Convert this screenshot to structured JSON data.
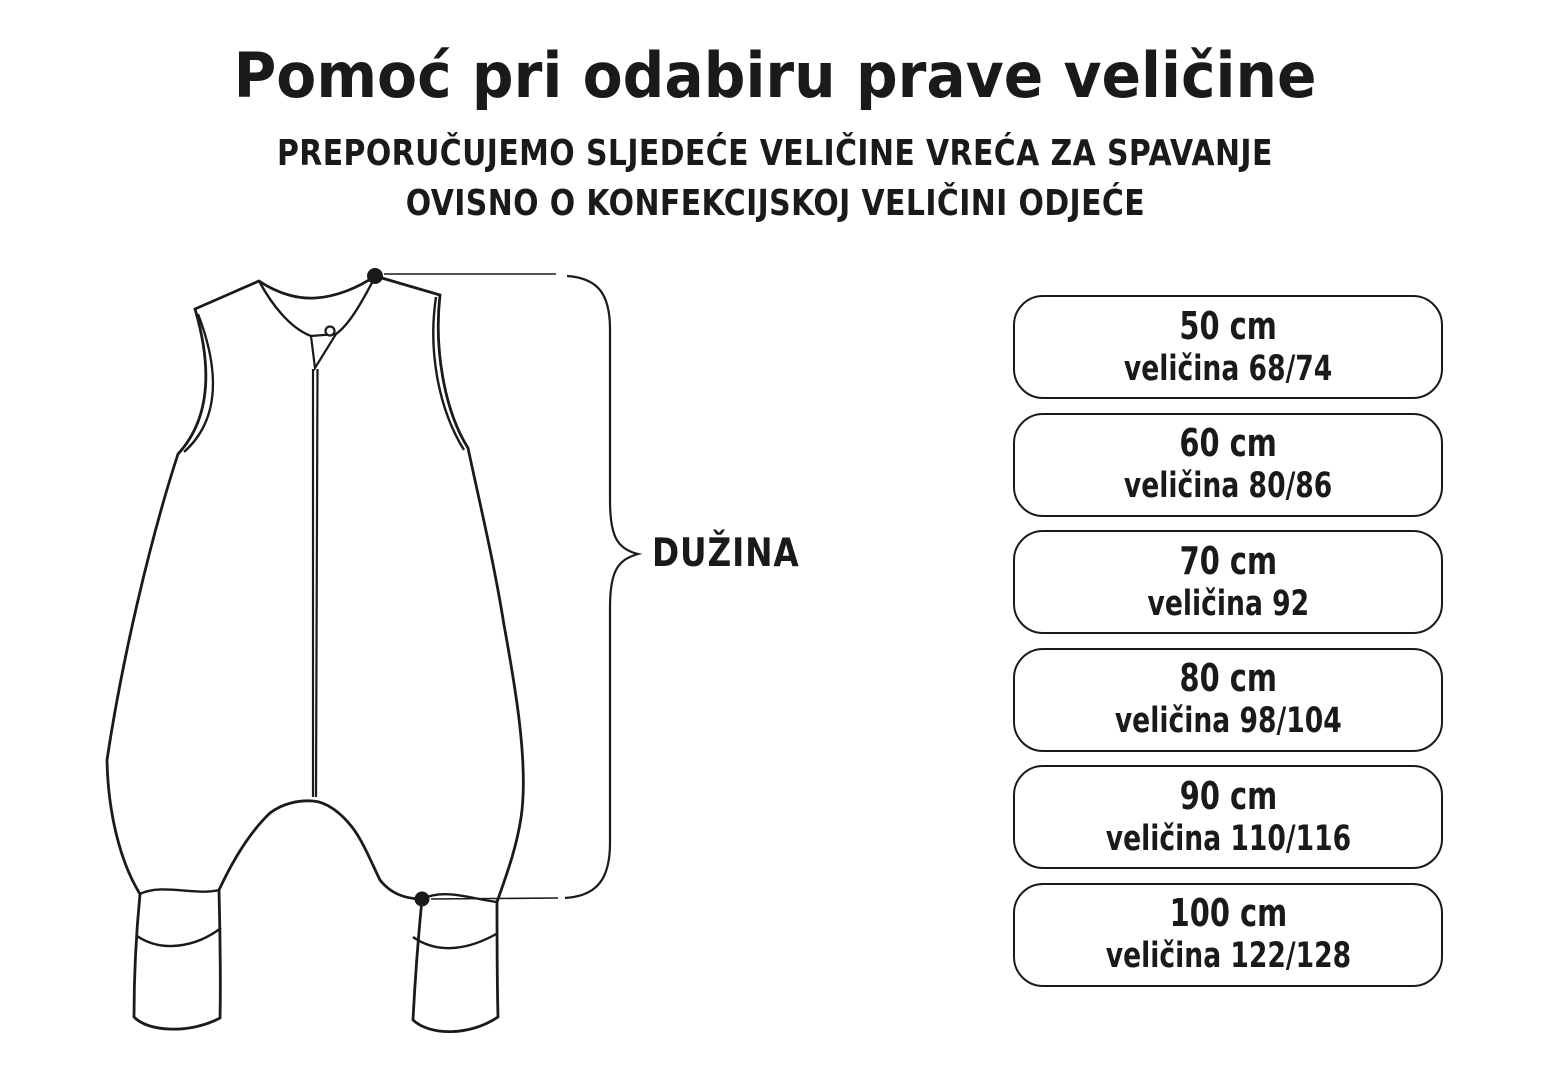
{
  "title": "Pomoć pri odabiru prave veličine",
  "subtitle_line1": "PREPORUČUJEMO SLJEDEĆE VELIČINE VREĆA ZA SPAVANJE",
  "subtitle_line2": "OVISNO O KONFEKCIJSKOJ VELIČINI ODJEĆE",
  "diagram": {
    "measurement_label": "DUŽINA",
    "drawing_subject": "sleeping-bag-with-legs"
  },
  "sizes": [
    {
      "length": "50 cm",
      "size": "veličina 68/74"
    },
    {
      "length": "60 cm",
      "size": "veličina 80/86"
    },
    {
      "length": "70 cm",
      "size": "veličina 92"
    },
    {
      "length": "80 cm",
      "size": "veličina 98/104"
    },
    {
      "length": "90 cm",
      "size": "veličina 110/116"
    },
    {
      "length": "100 cm",
      "size": "veličina 122/128"
    }
  ],
  "colors": {
    "ink": "#1a1a1a",
    "background": "#ffffff"
  }
}
